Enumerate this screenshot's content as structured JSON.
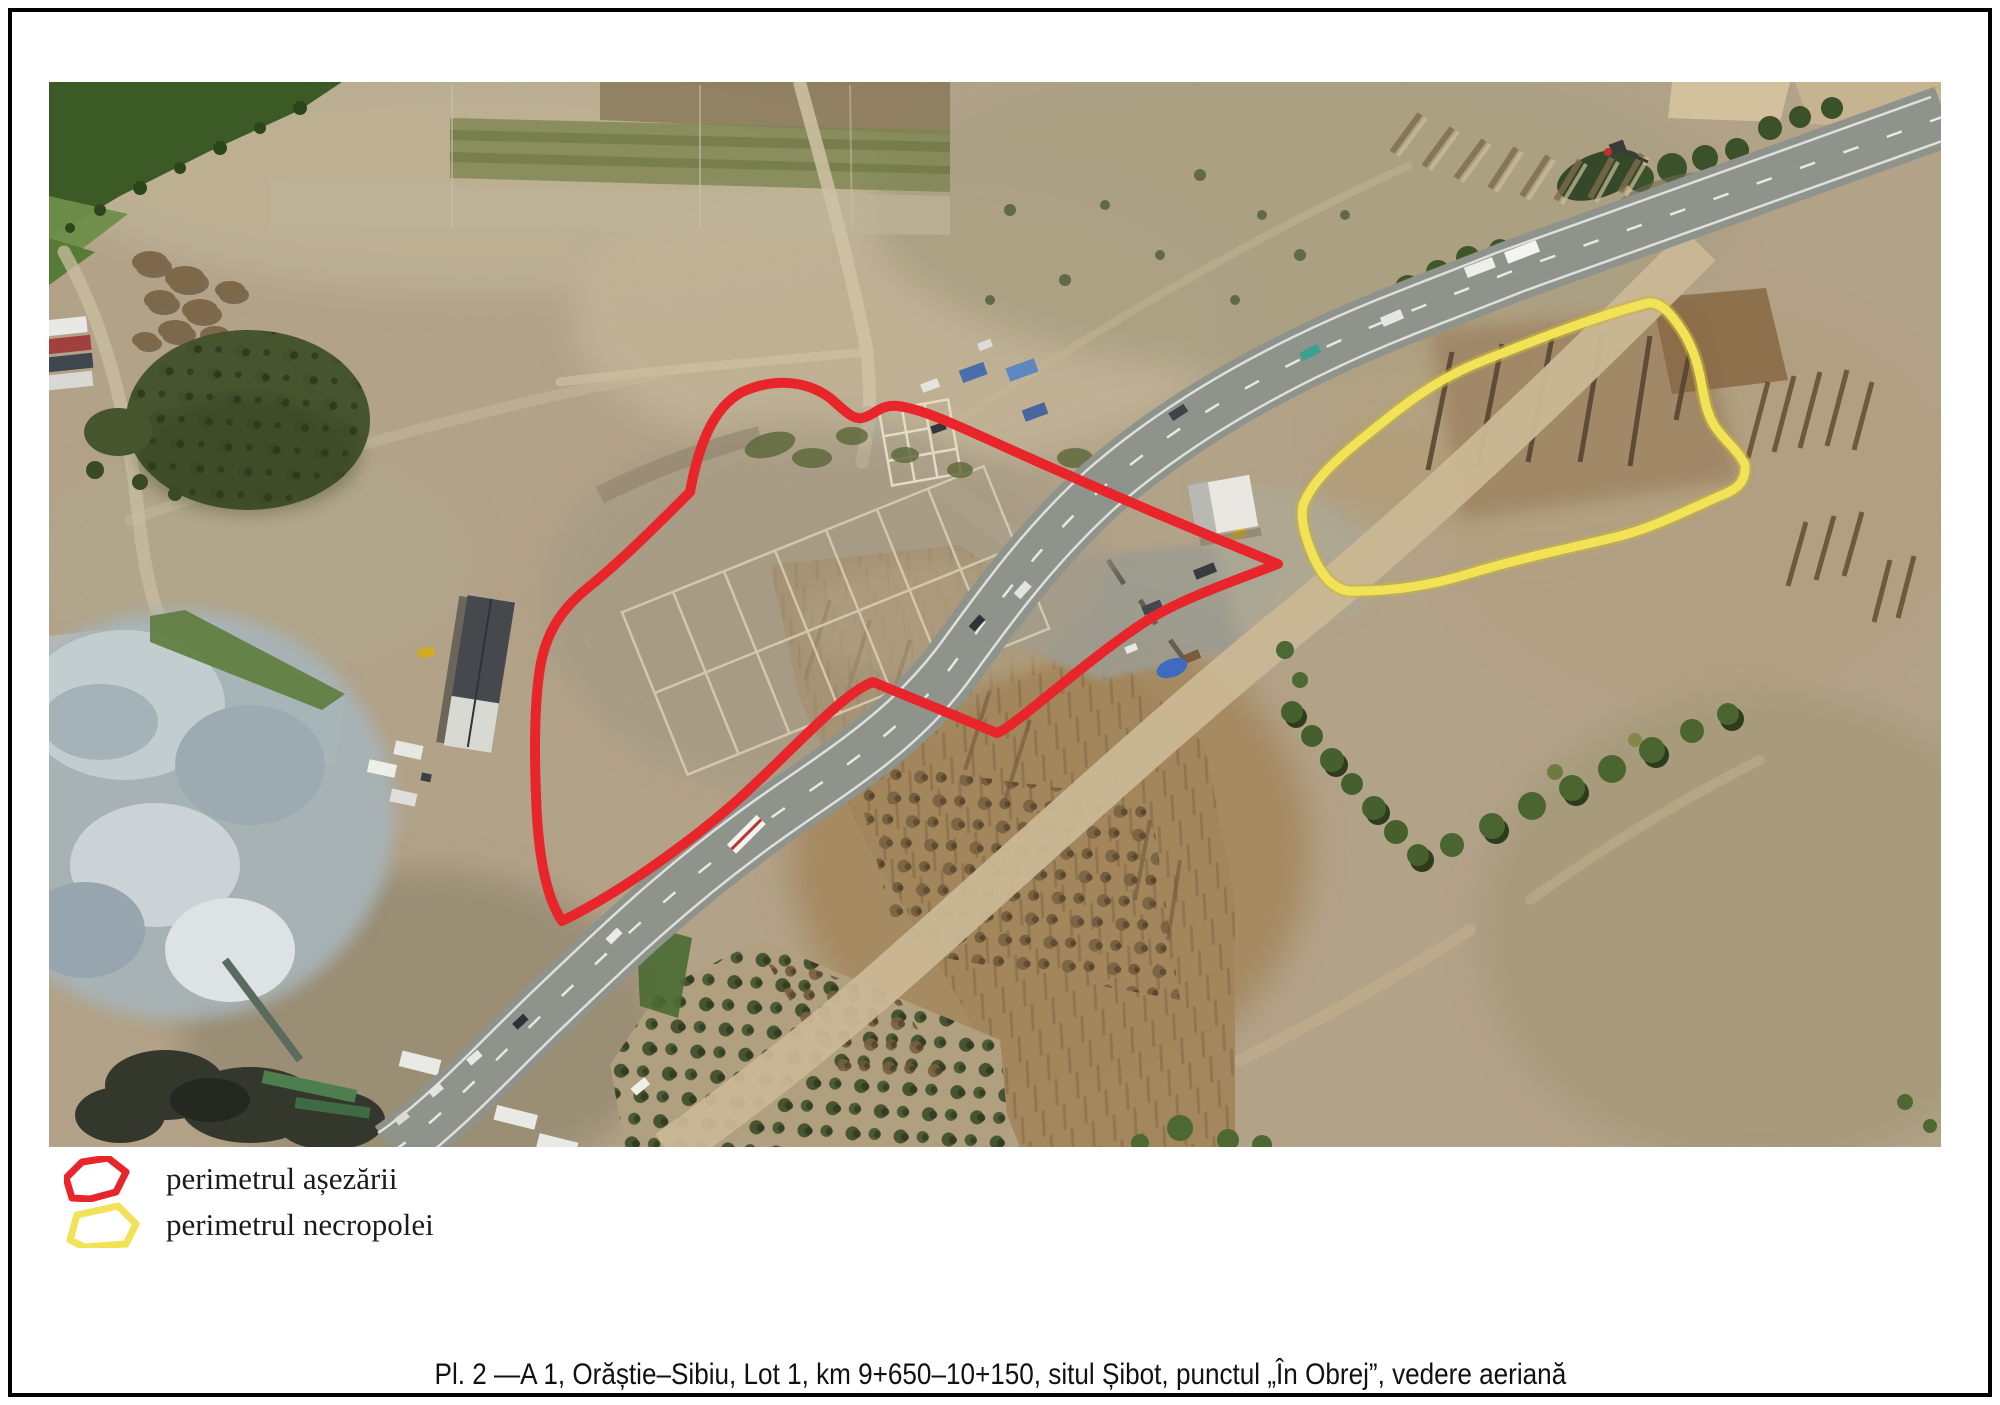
{
  "figure": {
    "caption": "Pl. 2 —A 1, Orăștie–Sibiu, Lot 1, km 9+650–10+150, situl Șibot, punctul „În Obrej”, vedere aeriană",
    "legend": {
      "items": [
        {
          "id": "settlement",
          "label": "perimetrul așezării",
          "color": "#e8252a"
        },
        {
          "id": "necropolis",
          "label": "perimetrul necropolei",
          "color": "#f2e256"
        }
      ]
    },
    "photo": {
      "type": "aerial-photograph",
      "overlays": [
        {
          "name": "settlement-perimeter",
          "color": "#e8252a"
        },
        {
          "name": "necropolis-perimeter",
          "color": "#f2e256"
        }
      ]
    }
  }
}
